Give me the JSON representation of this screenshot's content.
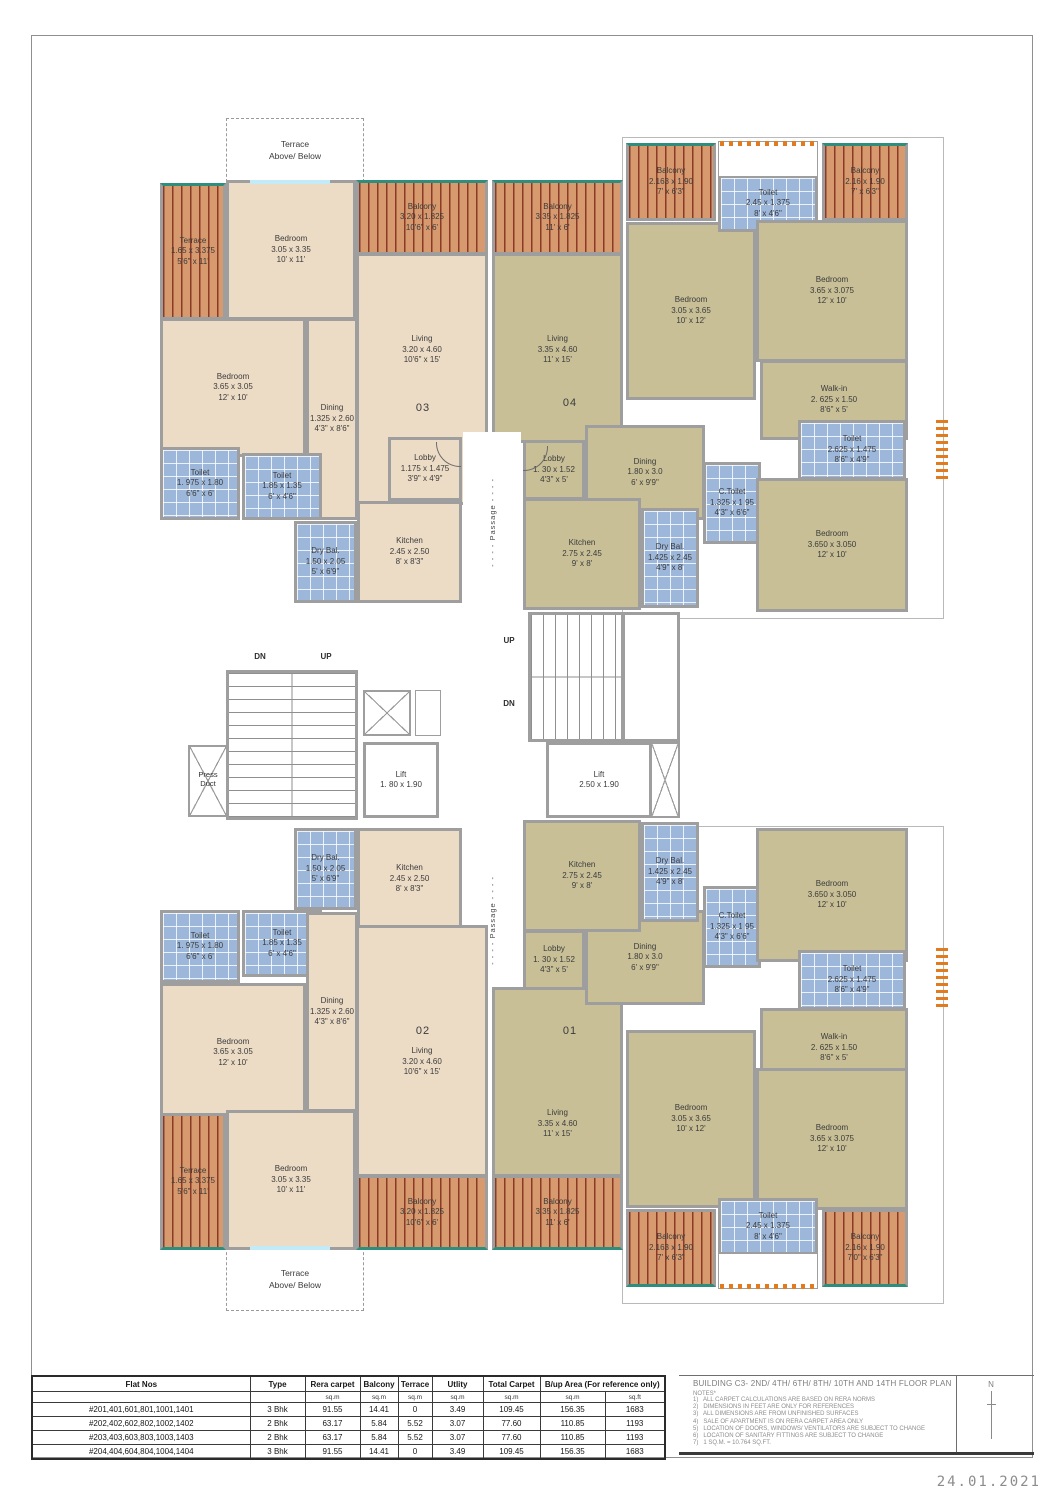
{
  "flats": {
    "c": {
      "terrace": [
        "Terrace",
        "1.65 x 3.375",
        "5'6\" x 11'"
      ],
      "bedroom_a": [
        "Bedroom",
        "3.05 x 3.35",
        "10' x 11'"
      ],
      "balcony": [
        "Balcony",
        "3.20 x 1.825",
        "10'6\" x 6'"
      ],
      "living": [
        "Living",
        "3.20 x 4.60",
        "10'6\" x 15'"
      ],
      "bedroom_b": [
        "Bedroom",
        "3.65 x 3.05",
        "12' x 10'"
      ],
      "dining": [
        "Dining",
        "1.325 x 2.60",
        "4'3\" x 8'6\""
      ],
      "toilet_a": [
        "Toilet",
        "1. 975 x 1.80",
        "6'6\" x 6'"
      ],
      "toilet_b": [
        "Toilet",
        "1.85 x 1.35",
        "6' x 4'6\""
      ],
      "dry_bal": [
        "Dry Bal.",
        "1.50 x 2.05",
        "5' x 6'9\""
      ],
      "kitchen": [
        "Kitchen",
        "2.45 x 2.50",
        "8' x 8'3\""
      ],
      "lobby": [
        "Lobby",
        "1.175 x 1.475",
        "3'9\" x 4'9\""
      ]
    },
    "k": {
      "balcony_l": [
        "Balcony",
        "3.35 x 1.825",
        "11' x 6'"
      ],
      "living": [
        "Living",
        "3.35 x 4.60",
        "11' x 15'"
      ],
      "dining": [
        "Dining",
        "1.80 x 3.0",
        "6' x 9'9\""
      ],
      "lobby": [
        "Lobby",
        "1. 30 x 1.52",
        "4'3\" x 5'"
      ],
      "kitchen": [
        "Kitchen",
        "2.75 x 2.45",
        "9' x 8'"
      ],
      "dry_bal": [
        "Dry Bal.",
        "1.425 x 2.45",
        "4'9\" x 8'"
      ],
      "c_toilet": [
        "C.Toilet",
        "1.325 x 1.95",
        "4'3\" x 6'6\""
      ],
      "bedroom_a": [
        "Bedroom",
        "3.05 x 3.65",
        "10' x 12'"
      ],
      "toilet_top": [
        "Toilet",
        "2.45 x 1.375",
        "8' x 4'6\""
      ],
      "bedroom_b": [
        "Bedroom",
        "3.65 x 3.075",
        "12' x 10'"
      ],
      "balcony_a": [
        "Balcony",
        "2.163 x 1.90",
        "7' x 6'3\""
      ],
      "balcony_b": [
        "Balcony",
        "2.16 x 1.90",
        "7' x 6'3\""
      ],
      "balcony_b_01": [
        "Balcony",
        "2.16 x 1.90",
        "7'0\" x 6'3\""
      ],
      "walk_in": [
        "Walk-in",
        "2. 625 x 1.50",
        "8'6\" x 5'"
      ],
      "toilet_r": [
        "Toilet",
        "2.625 x 1.475",
        "8'6\" x 4'9\""
      ],
      "bedroom_c": [
        "Bedroom",
        "3.650 x 3.050",
        "12' x 10'"
      ]
    }
  },
  "unit_numbers": {
    "u01": "01",
    "u02": "02",
    "u03": "03",
    "u04": "04"
  },
  "core": {
    "dn": "DN",
    "up": "UP",
    "lift_small": [
      "Lift",
      "1. 80 x 1.90"
    ],
    "lift_large": [
      "Lift",
      "2.50 x 1.90"
    ],
    "press_duct": [
      "Press",
      "Duct"
    ],
    "passage": "- - - - Passage - - - -",
    "terrace_note": [
      "Terrace",
      "Above/ Below"
    ]
  },
  "table": {
    "headers": [
      "Flat Nos",
      "Type",
      "Rera carpet",
      "Balcony",
      "Terrace",
      "Utlity",
      "Total Carpet",
      "B/up Area (For reference only)"
    ],
    "units_row": [
      "",
      "",
      "sq.m",
      "sq.m",
      "sq.m",
      "sq.m",
      "sq.m",
      "sq.m",
      "sq.ft"
    ],
    "rows": [
      [
        "#201,401,601,801,1001,1401",
        "3 Bhk",
        "91.55",
        "14.41",
        "0",
        "3.49",
        "109.45",
        "156.35",
        "1683"
      ],
      [
        "#202,402,602,802,1002,1402",
        "2 Bhk",
        "63.17",
        "5.84",
        "5.52",
        "3.07",
        "77.60",
        "110.85",
        "1193"
      ],
      [
        "#203,403,603,803,1003,1403",
        "2 Bhk",
        "63.17",
        "5.84",
        "5.52",
        "3.07",
        "77.60",
        "110.85",
        "1193"
      ],
      [
        "#204,404,604,804,1004,1404",
        "3 Bhk",
        "91.55",
        "14.41",
        "0",
        "3.49",
        "109.45",
        "156.35",
        "1683"
      ]
    ]
  },
  "title_block": {
    "title": "BUILDING C3- 2ND/ 4TH/ 6TH/ 8TH/ 10TH AND 14TH FLOOR PLAN",
    "notes_heading": "NOTES*",
    "notes": [
      "1)   ALL CARPET CALCULATIONS ARE BASED ON RERA NORMS",
      "2)   DIMENSIONS IN FEET ARE ONLY FOR REFERENCES",
      "3)   ALL DIMENSIONS ARE FROM UNFINISHED SURFACES",
      "4)   SALE OF APARTMENT IS ON RERA CARPET AREA ONLY",
      "5)   LOCATION OF DOORS, WINDOWS/ VENTILATORS ARE SUBJECT TO CHANGE",
      "6)   LOCATION OF SANITARY FITTINGS ARE SUBJECT TO CHANGE",
      "7)   1 SQ.M. = 10.764 SQ.FT."
    ],
    "north_label": "N"
  },
  "date": "24.01.2021"
}
